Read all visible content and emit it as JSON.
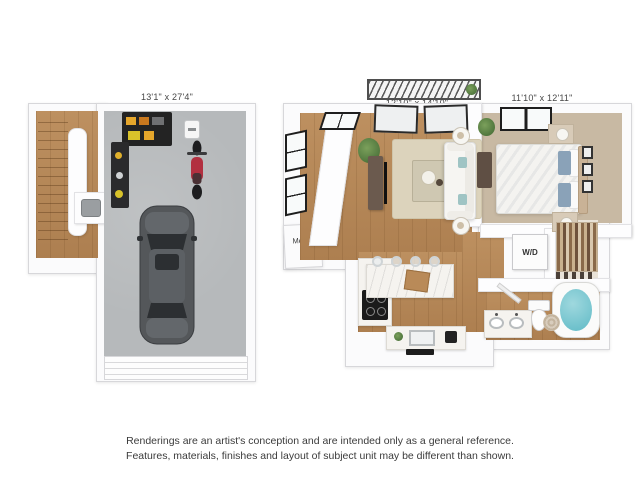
{
  "floorplans": {
    "garage_level": {
      "dimension_label": "13'1\" x 27'4\""
    },
    "main_level": {
      "living_room_dimension_label": "12'10\" x 14'10\"",
      "bedroom_dimension_label": "11'10\" x 12'11\"",
      "mech_closet_label": "Mech.",
      "washer_dryer_label": "W/D"
    }
  },
  "disclaimer": {
    "line1": "Renderings are an artist's conception and are intended only as a general reference.",
    "line2": "Features, materials, finishes and layout of subject unit may be different than shown."
  },
  "colors": {
    "background": "#ffffff",
    "wall_fill": "#fbfbfc",
    "wall_edge": "#d7d7da",
    "garage_floor": "#b6b9bb",
    "wood_floor": "#bd9060",
    "carpet": "#c8b9a3",
    "rug": "#dcd3bc",
    "counter_white": "#f5f3ef",
    "car_body": "#54575a",
    "car_glass": "#2c2f32",
    "motorcycle_red": "#b23040",
    "tub_teal": "#5fbac6",
    "shelf_black": "#232323",
    "bin_yellow": "#e5a62b",
    "label_text": "#474747",
    "disclaimer_text": "#3b3b3b"
  }
}
